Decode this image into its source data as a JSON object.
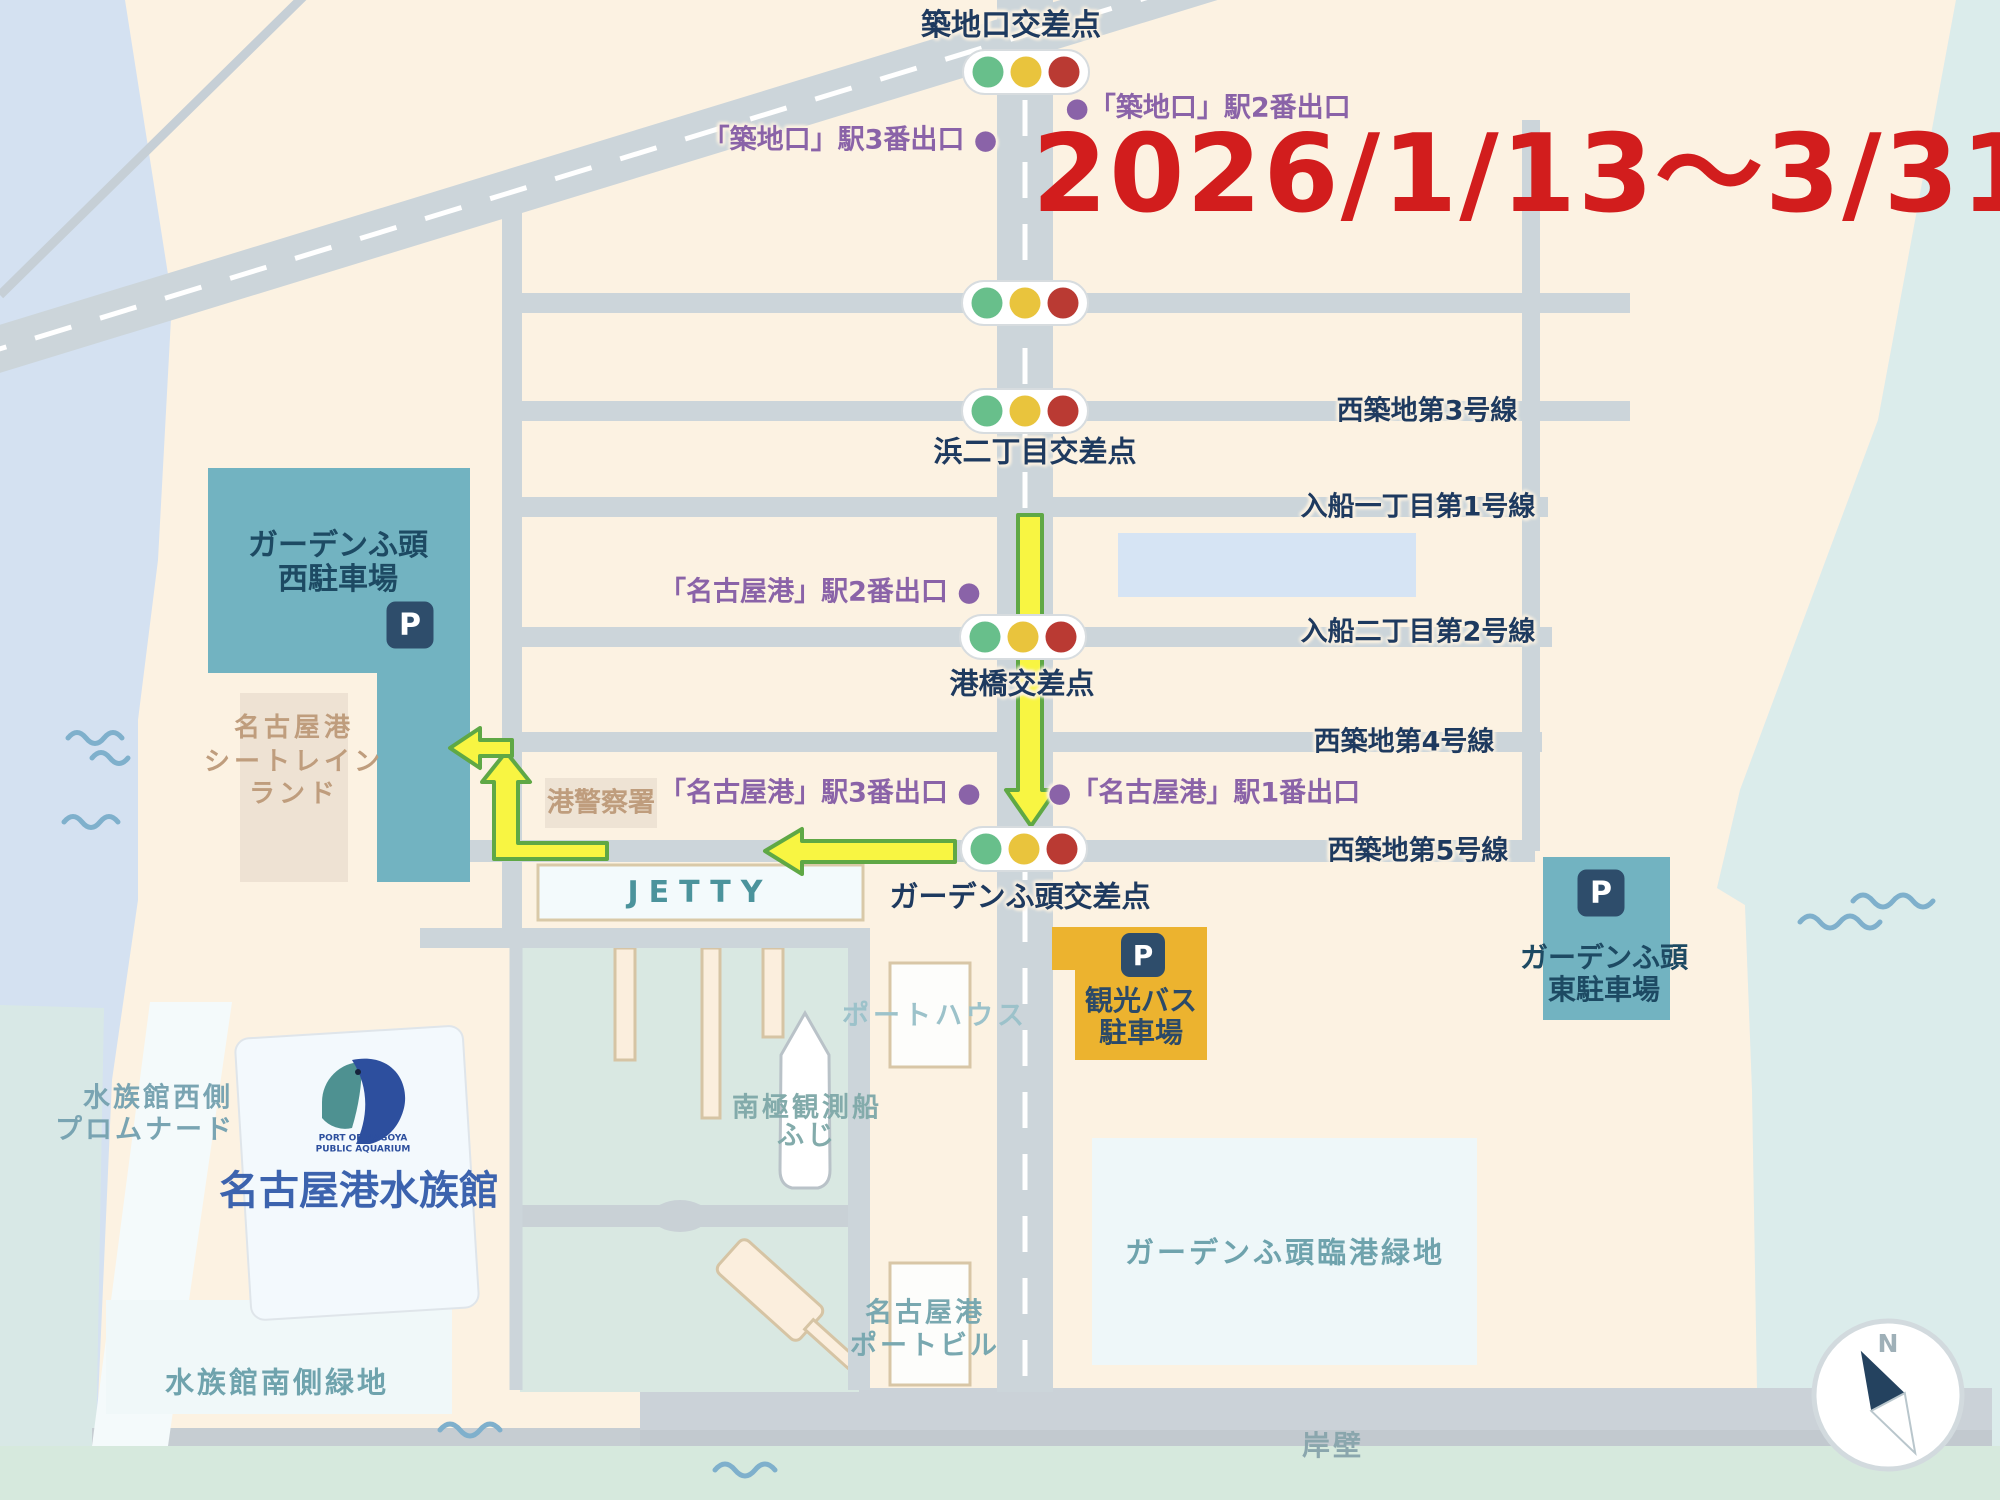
{
  "period": "2026/1/13～3/31",
  "compass_n": "N",
  "intersections": [
    "築地口交差点",
    "浜二丁目交差点",
    "港橋交差点",
    "ガーデンふ頭交差点"
  ],
  "roads": [
    "西築地第3号線",
    "入船一丁目第1号線",
    "入船二丁目第2号線",
    "西築地第4号線",
    "西築地第5号線"
  ],
  "station_exits": {
    "tsukijiguchi_exit3": "「築地口」駅3番出口 ●",
    "tsukijiguchi_exit2": "●「築地口」駅2番出口",
    "nagoyako_exit2": "「名古屋港」駅2番出口 ●",
    "nagoyako_exit3": "「名古屋港」駅3番出口 ●",
    "nagoyako_exit1": "●「名古屋港」駅1番出口"
  },
  "parking": {
    "p_mark": "P",
    "west": {
      "line1": "ガーデンふ頭",
      "line2": "西駐車場"
    },
    "east": {
      "line1": "ガーデンふ頭",
      "line2": "東駐車場"
    },
    "bus": {
      "line1": "観光バス",
      "line2": "駐車場"
    }
  },
  "places": {
    "seatrain": {
      "line1": "名古屋港",
      "line2": "シートレイン",
      "line3": "ランド"
    },
    "police": "港警察署",
    "jetty": "JETTY",
    "porthouse": "ポートハウス",
    "fuji": {
      "line1": "南極観測船",
      "line2": "ふじ"
    },
    "aquarium": {
      "name": "名古屋港水族館",
      "sub1": "PORT OF NAGOYA",
      "sub2": "PUBLIC AQUARIUM"
    },
    "promenade": {
      "line1": "水族館西側",
      "line2": "プロムナード"
    },
    "south_green": "水族館南側緑地",
    "portbldg": {
      "line1": "名古屋港",
      "line2": "ポートビル"
    },
    "rinko_green": "ガーデンふ頭臨港緑地",
    "quay": "岸壁"
  },
  "colors": {
    "water_blue": "#d4e1f1",
    "sea_green": "#d6e9dd",
    "sea_cyan": "#dbeceb",
    "land": "#fcf2e2",
    "road": "#ccd5da",
    "parking_teal": "#72b3c1",
    "bus_orange": "#ecb32f",
    "route_yellow": "#f8f542",
    "route_green": "#5fa845",
    "label_navy": "#1e3a5f",
    "exit_purple": "#8a63a8",
    "date_red": "#d21d1d",
    "signal_green": "#68bf8b",
    "signal_yellow": "#e9c43d",
    "signal_red": "#ba3a33"
  }
}
